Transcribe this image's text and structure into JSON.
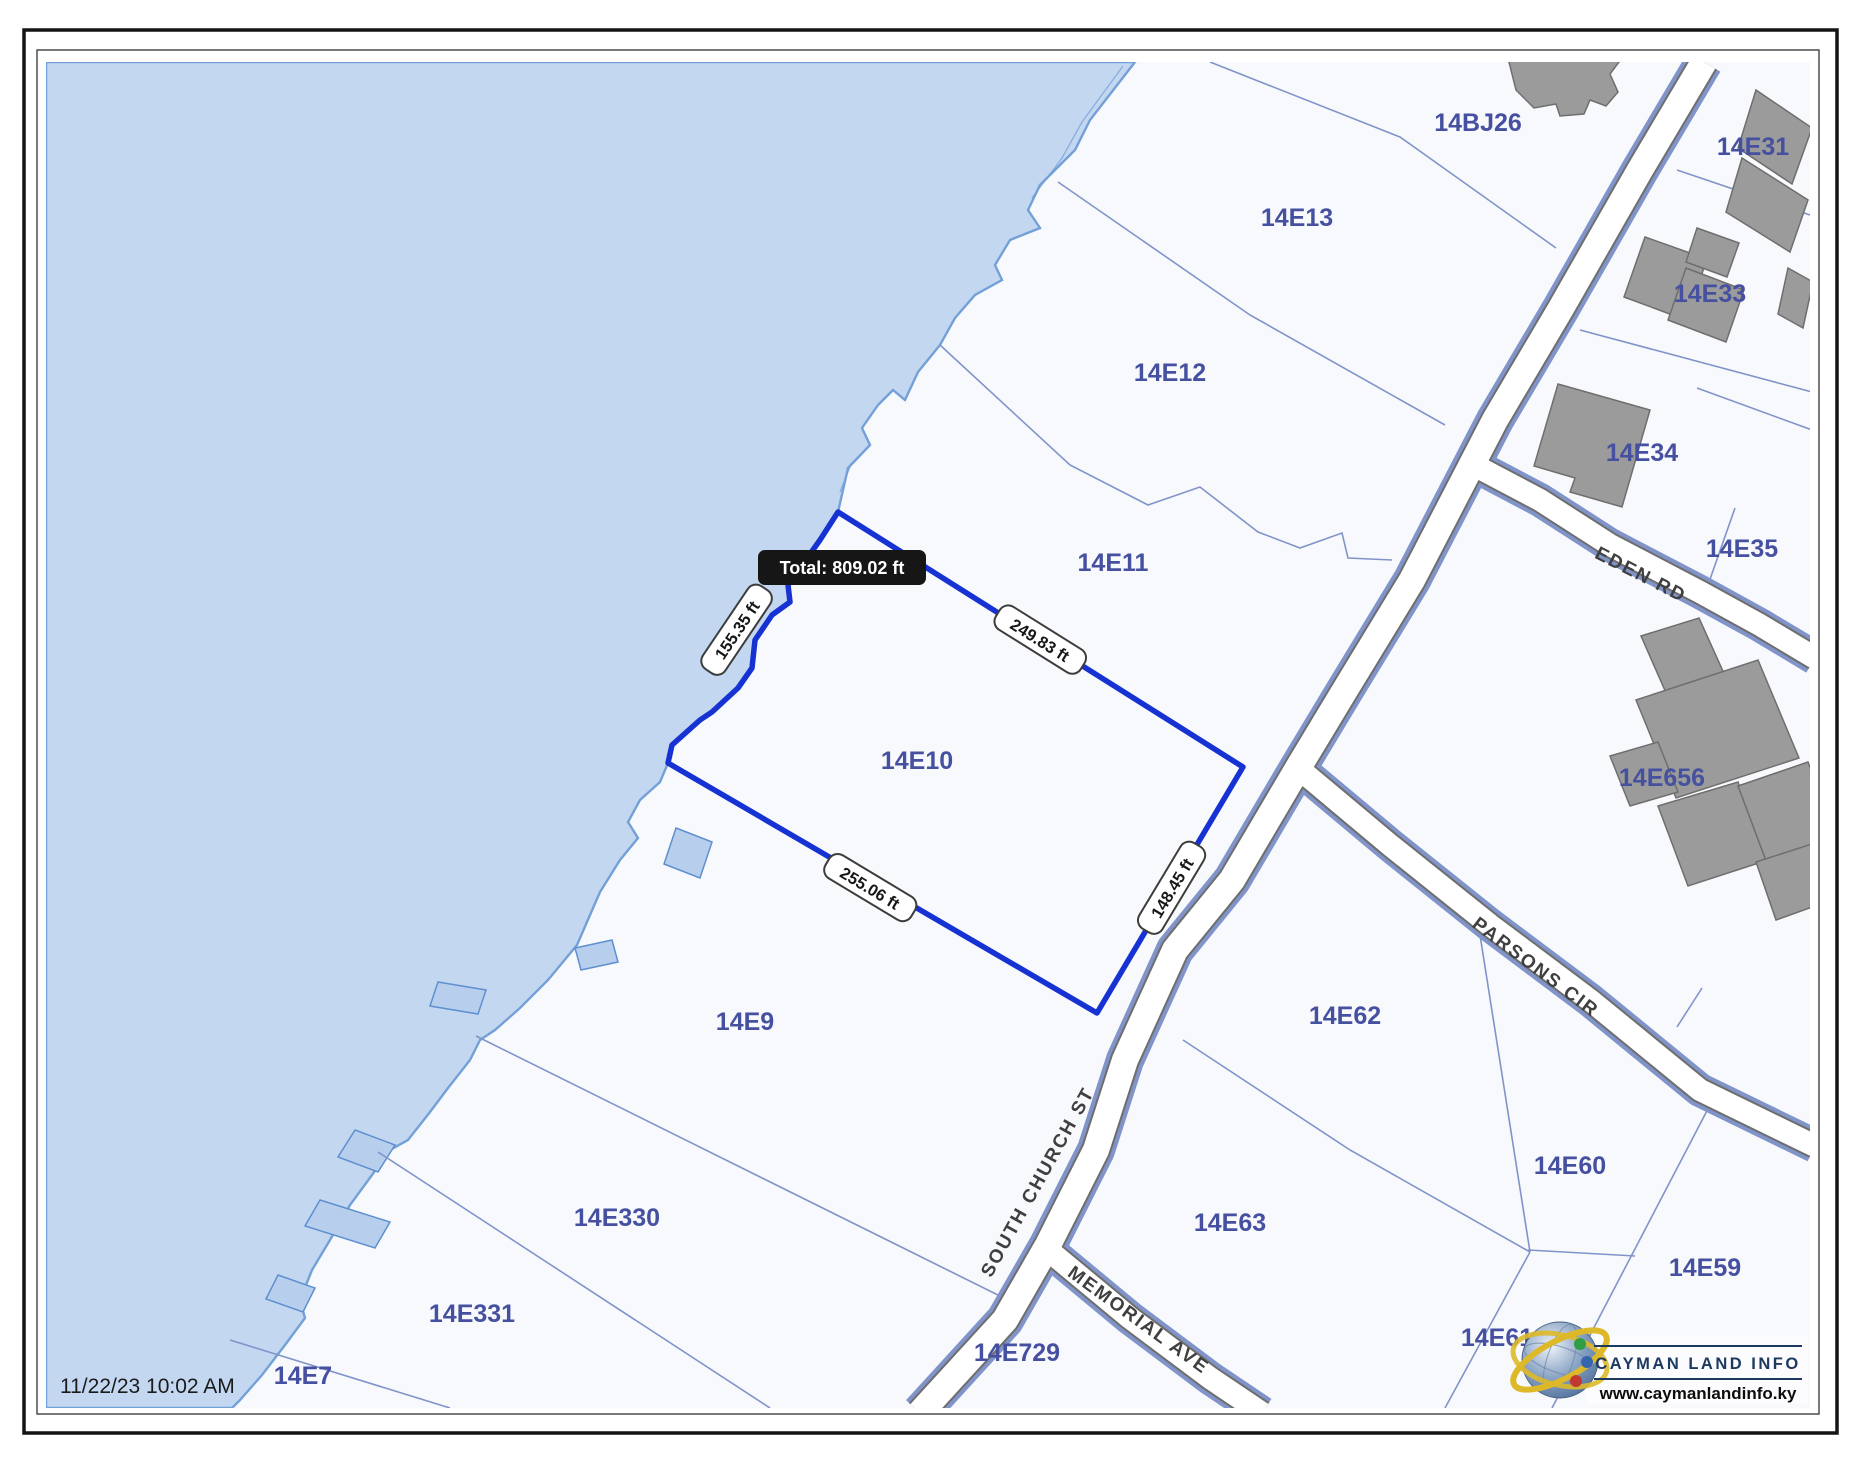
{
  "map": {
    "timestamp": "11/22/23 10:02 AM",
    "tooltip": {
      "total_label": "Total: 809.02 ft"
    },
    "selected_parcel": "14E10",
    "measurements": [
      {
        "side": "northeast",
        "value": "249.83 ft"
      },
      {
        "side": "coastline",
        "value": "155.35 ft"
      },
      {
        "side": "south",
        "value": "255.06 ft"
      },
      {
        "side": "road-side",
        "value": "148.45 ft"
      }
    ],
    "parcels": [
      {
        "label": "14BJ26"
      },
      {
        "label": "14E13"
      },
      {
        "label": "14E31"
      },
      {
        "label": "14E12"
      },
      {
        "label": "14E33"
      },
      {
        "label": "14E34"
      },
      {
        "label": "14E35"
      },
      {
        "label": "14E11"
      },
      {
        "label": "14E656"
      },
      {
        "label": "14E10"
      },
      {
        "label": "14E62"
      },
      {
        "label": "14E9"
      },
      {
        "label": "14E60"
      },
      {
        "label": "14E63"
      },
      {
        "label": "14E330"
      },
      {
        "label": "14E59"
      },
      {
        "label": "14E331"
      },
      {
        "label": "14E61"
      },
      {
        "label": "14E729"
      },
      {
        "label": "14E7"
      }
    ],
    "roads": [
      {
        "name": "SOUTH CHURCH ST"
      },
      {
        "name": "MEMORIAL AVE"
      },
      {
        "name": "EDEN RD"
      },
      {
        "name": "PARSONS CIR"
      }
    ],
    "colors": {
      "water": "#c3d8f0",
      "land": "#f8f9fc",
      "parcel_line": "#8094ca",
      "selected_outline": "#1632d2",
      "building": "#9b9b9b",
      "road_casing": "#6e6e6e",
      "parcel_label": "#4650a0",
      "tooltip_bg": "#161616",
      "logo_navy": "#1c3a60",
      "logo_yellow": "#ddb92a"
    }
  },
  "logo": {
    "title": "CAYMAN LAND INFO",
    "url": "www.caymanlandinfo.ky"
  }
}
